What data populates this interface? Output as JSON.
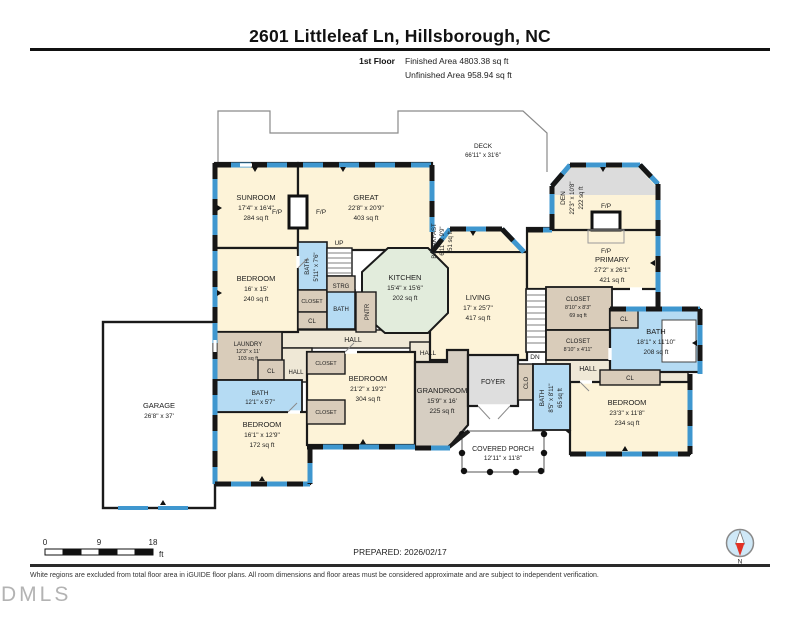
{
  "header": {
    "title": "2601 Littleleaf Ln, Hillsborough, NC",
    "floor_label": "1st Floor",
    "finished": "Finished Area 4803.38 sq ft",
    "unfinished": "Unfinished Area 958.94 sq ft"
  },
  "r": {
    "deck": {
      "n": "DECK",
      "d": "66'11\" x 31'6\""
    },
    "sunroom": {
      "n": "SUNROOM",
      "d": "17'4\" x 16'4\"",
      "a": "284 sq ft"
    },
    "great": {
      "n": "GREAT",
      "d": "22'8\" x 20'9\"",
      "a": "403 sq ft"
    },
    "den": {
      "n": "DEN",
      "d": "22'3\" x 10'8\"",
      "a": "222 sq ft"
    },
    "breakfast": {
      "n": "BREAKFAST",
      "d": "6'11\" x 9'9\"",
      "a": "51 sq ft"
    },
    "kitchen": {
      "n": "KITCHEN",
      "d": "15'4\" x 15'6\"",
      "a": "202 sq ft"
    },
    "living": {
      "n": "LIVING",
      "d": "17' x 25'7\"",
      "a": "417 sq ft"
    },
    "primary": {
      "n": "PRIMARY",
      "d": "27'2\" x 26'1\"",
      "a": "421 sq ft"
    },
    "bedroom1": {
      "n": "BEDROOM",
      "d": "16' x 15'",
      "a": "240 sq ft"
    },
    "bath1": {
      "n": "BATH",
      "d": "5'11\" x 7'6\""
    },
    "laundry": {
      "n": "LAUNDRY",
      "d": "12'3\" x 11'",
      "a": "103 sq ft"
    },
    "garage": {
      "n": "GARAGE",
      "d": "26'8\" x 37'"
    },
    "bath2": {
      "n": "BATH",
      "d": "12'1\" x 5'7\""
    },
    "bedroom2": {
      "n": "BEDROOM",
      "d": "16'1\" x 12'9\"",
      "a": "172 sq ft"
    },
    "bedroom3": {
      "n": "BEDROOM",
      "d": "21'2\" x 19'2\"",
      "a": "304 sq ft"
    },
    "grandroom": {
      "n": "GRANDROOM",
      "d": "15'9\" x 16'",
      "a": "225 sq ft"
    },
    "foyer": {
      "n": "FOYER"
    },
    "porch": {
      "n": "COVERED PORCH",
      "d": "12'11\" x 11'8\""
    },
    "bath3": {
      "n": "BATH",
      "d": "8'5\" x 8'11\"",
      "a": "65 sq ft"
    },
    "bedroom4": {
      "n": "BEDROOM",
      "d": "23'3\" x 11'8\"",
      "a": "234 sq ft"
    },
    "bath4": {
      "n": "BATH",
      "d": "18'1\" x 11'10\"",
      "a": "208 sq ft"
    },
    "closet1": {
      "n": "CLOSET",
      "d": "8'10\" x 8'3\"",
      "a": "69 sq ft"
    },
    "closet2": {
      "n": "CLOSET",
      "d": "8'10\" x 4'11\""
    }
  },
  "lbl": {
    "up": "UP",
    "dn": "DN",
    "hall": "HALL",
    "cl": "CL",
    "closet": "CLOSET",
    "clo": "CLO",
    "strg": "STRG",
    "pntr": "PNTR",
    "fp": "F/P"
  },
  "scale": {
    "t0": "0",
    "t9": "9",
    "t18": "18",
    "unit": "ft"
  },
  "compass": {
    "n": "N"
  },
  "footer": {
    "prepared": "PREPARED: 2026/02/17",
    "disclaimer": "White regions are excluded from total floor area in iGUIDE floor plans. All room dimensions and floor areas must be considered approximate and are subject to independent verification.",
    "watermark": "DMLS"
  },
  "colors": {
    "room_cream": "#fdf3d8",
    "kitchen_green": "#e2ecdc",
    "bath_blue": "#b5dbf3",
    "closet_tan": "#d9ccba",
    "grand_tan": "#d6cec2",
    "foyer_gray": "#dedede",
    "hall": "#efe8d6",
    "window_blue": "#3f97cf",
    "wall": "#1a1a1a",
    "compass_red": "#e23125",
    "compass_blue": "#cfe8f7"
  }
}
